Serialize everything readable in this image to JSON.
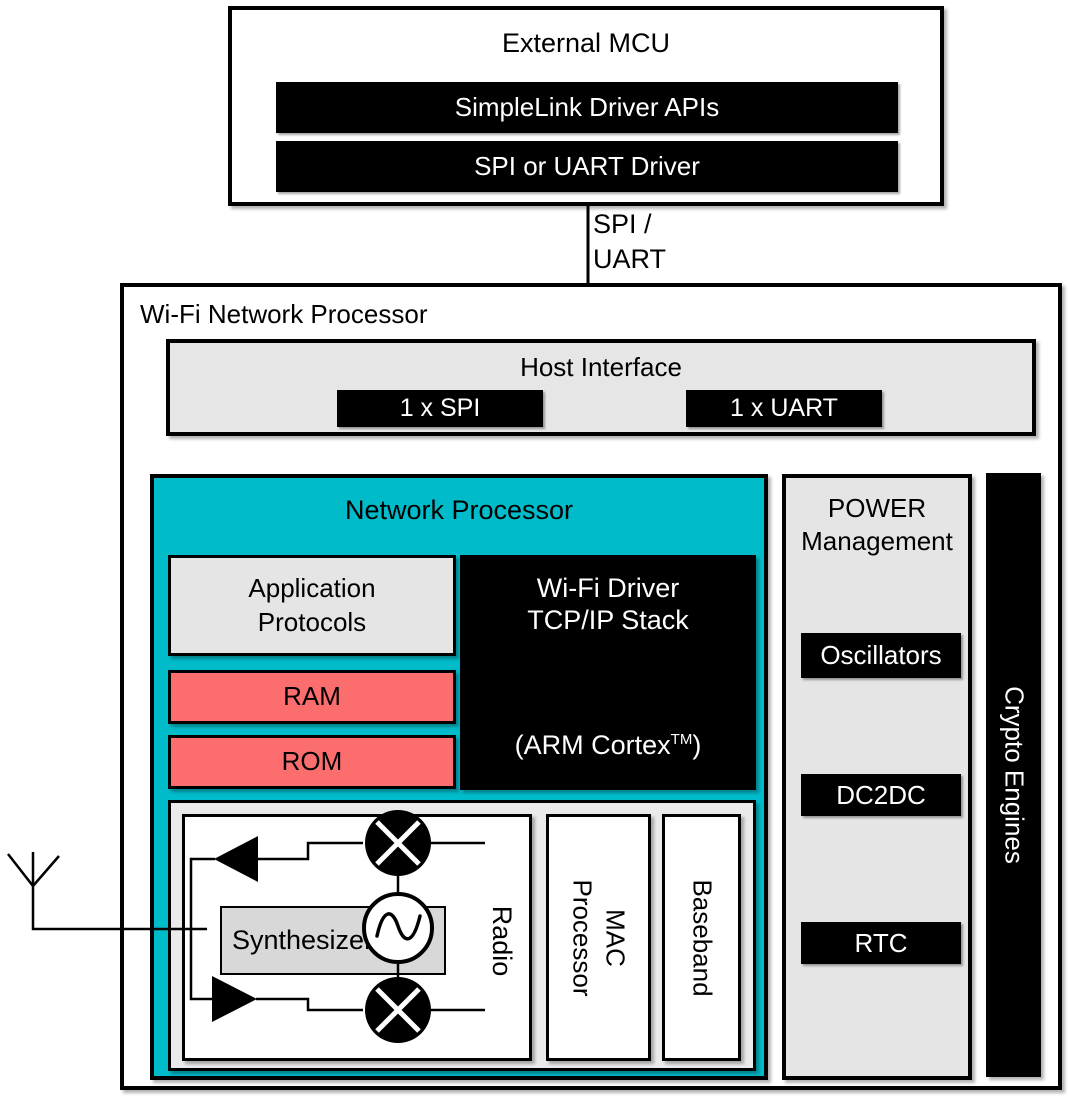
{
  "colors": {
    "cyan_accent": "#00bcca",
    "memory_red": "#fc6e6e",
    "panel_gray": "#e6e6e6",
    "synth_gray": "#d8d8d8",
    "bar_black": "#000000"
  },
  "external_mcu": {
    "title": "External MCU",
    "bars": [
      "SimpleLink Driver APIs",
      "SPI or UART Driver"
    ]
  },
  "connector": {
    "lines": [
      "SPI /",
      "UART"
    ]
  },
  "processor": {
    "title": "Wi-Fi Network Processor",
    "host_interface": {
      "title": "Host Interface",
      "bars": [
        "1 x SPI",
        "1 x UART"
      ]
    },
    "network_processor": {
      "title": "Network Processor",
      "application_protocols": {
        "lines": [
          "Application",
          "Protocols"
        ]
      },
      "wifi_driver": {
        "lines": [
          "Wi-Fi Driver",
          "TCP/IP Stack"
        ],
        "cpu_pre": "(ARM Cortex",
        "cpu_sup": "TM",
        "cpu_post": ")"
      },
      "memory": [
        "RAM",
        "ROM"
      ],
      "radio": {
        "label": "Radio",
        "synthesizer": "Synthesizer"
      },
      "mac_processor": {
        "lines": [
          "MAC",
          "Processor"
        ]
      },
      "baseband": "Baseband"
    },
    "power_management": {
      "title_lines": [
        "POWER",
        "Management"
      ],
      "bars": [
        "Oscillators",
        "DC2DC",
        "RTC"
      ]
    },
    "crypto_engines": "Crypto Engines"
  }
}
